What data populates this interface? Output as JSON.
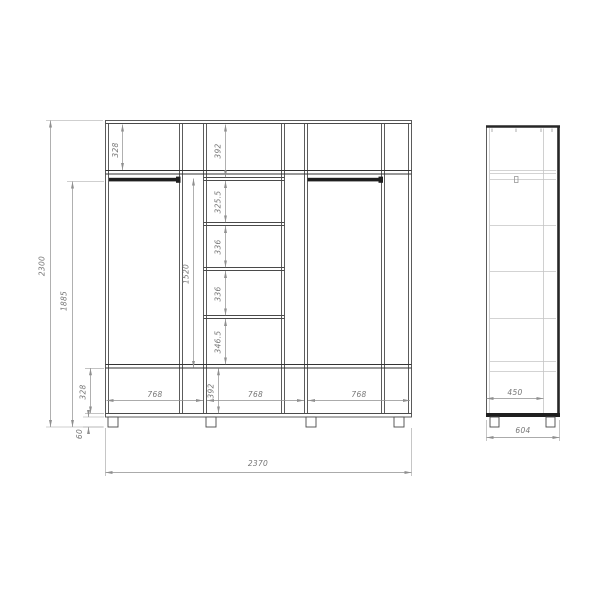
{
  "drawing_title": "wardrobe-technical-drawing",
  "front_view": {
    "overall_width": "2370",
    "overall_height": "2300",
    "hanging_zone_height": "1885",
    "rod_clearance": "1520",
    "top_shelf": "328",
    "bottom_shelf": "328",
    "feet_height": "60",
    "sections": {
      "s1": "392",
      "s2": "325.5",
      "s3": "336",
      "s4": "336",
      "s5": "346.5",
      "s6": "392"
    },
    "widths": {
      "w1": "768",
      "w2": "768",
      "w3": "768"
    }
  },
  "side_view": {
    "inner_depth": "450",
    "overall_depth": "604"
  },
  "colors": {
    "background": "#ffffff",
    "structure_line": "#4a4a4a",
    "dark_line": "#1f1f1f",
    "light_line": "#c4c4c4",
    "dimension_line": "#8f8f8f",
    "dimension_text": "#767676"
  }
}
